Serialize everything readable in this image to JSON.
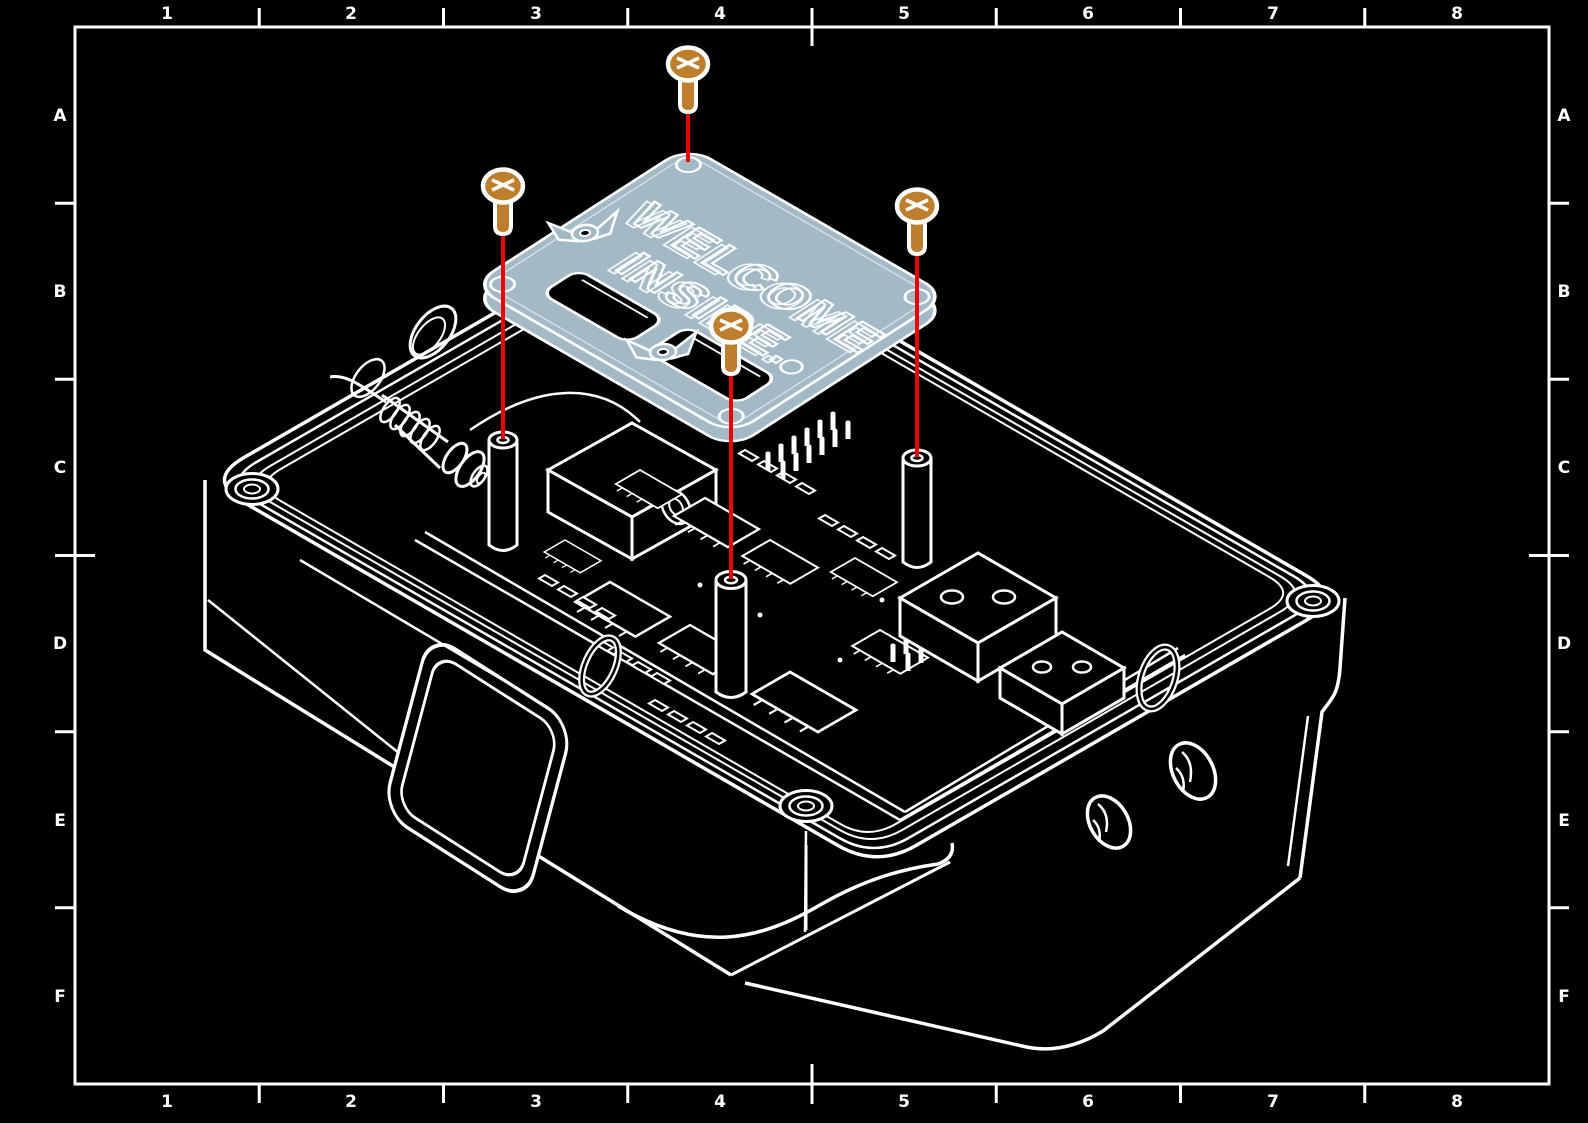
{
  "frame": {
    "column_labels": [
      "1",
      "2",
      "3",
      "4",
      "5",
      "6",
      "7",
      "8"
    ],
    "row_labels": [
      "A",
      "B",
      "C",
      "D",
      "E",
      "F"
    ]
  },
  "illustration": {
    "type": "exploded-assembly-technical-drawing",
    "plate_engraving": {
      "line1": "WELCOME",
      "line2": "INSIDE."
    },
    "screw_count": "4",
    "colors": {
      "background": "#000000",
      "line_art": "#ffffff",
      "cover_plate": "#a3bac6",
      "screws": "#bd7e2e",
      "guide_lines": "#ed0000"
    }
  }
}
